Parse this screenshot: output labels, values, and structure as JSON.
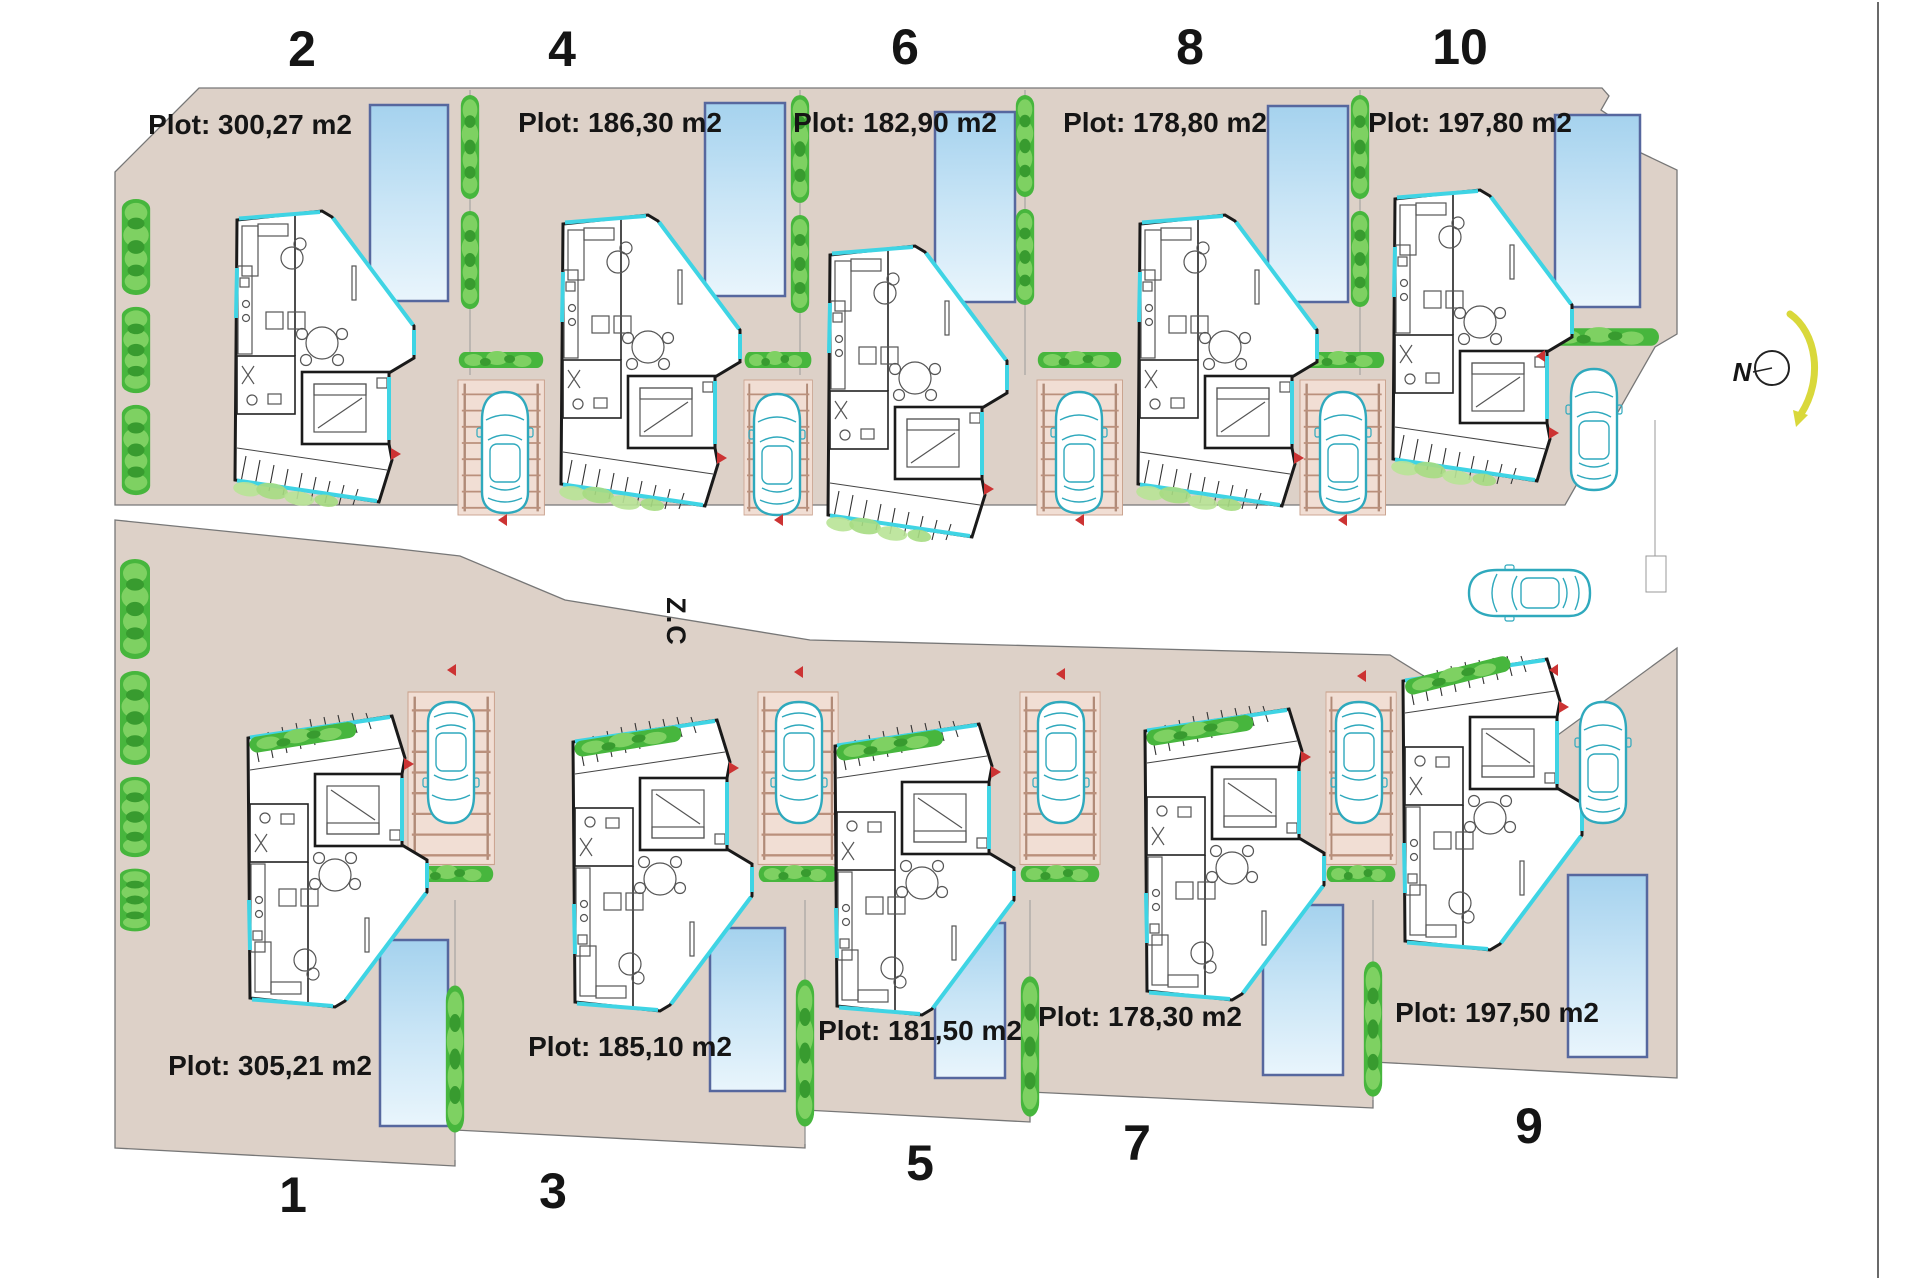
{
  "plan": {
    "street_label": "Z.C",
    "north_label": "N"
  },
  "plots": [
    {
      "number": "2",
      "area_label": "Plot: 300,27 m2"
    },
    {
      "number": "4",
      "area_label": "Plot: 186,30 m2"
    },
    {
      "number": "6",
      "area_label": "Plot: 182,90 m2"
    },
    {
      "number": "8",
      "area_label": "Plot: 178,80 m2"
    },
    {
      "number": "10",
      "area_label": "Plot: 197,80 m2"
    },
    {
      "number": "1",
      "area_label": "Plot: 305,21 m2"
    },
    {
      "number": "3",
      "area_label": "Plot: 185,10 m2"
    },
    {
      "number": "5",
      "area_label": "Plot: 181,50 m2"
    },
    {
      "number": "7",
      "area_label": "Plot: 178,30 m2"
    },
    {
      "number": "9",
      "area_label": "Plot: 197,50 m2"
    }
  ],
  "colors": {
    "ground": "#ddd1c8",
    "pool_top": "#a5d2ee",
    "pool_border": "#56679e",
    "hedge_green": "#47b63d",
    "glass_cyan": "#3fd4e4",
    "car_teal": "#2fa9bd",
    "pergola_tan": "#ba907c",
    "walls": "#1a1a1a",
    "north_arrow_yellow": "#d9d83b",
    "door_marker_red": "#cc3333"
  }
}
